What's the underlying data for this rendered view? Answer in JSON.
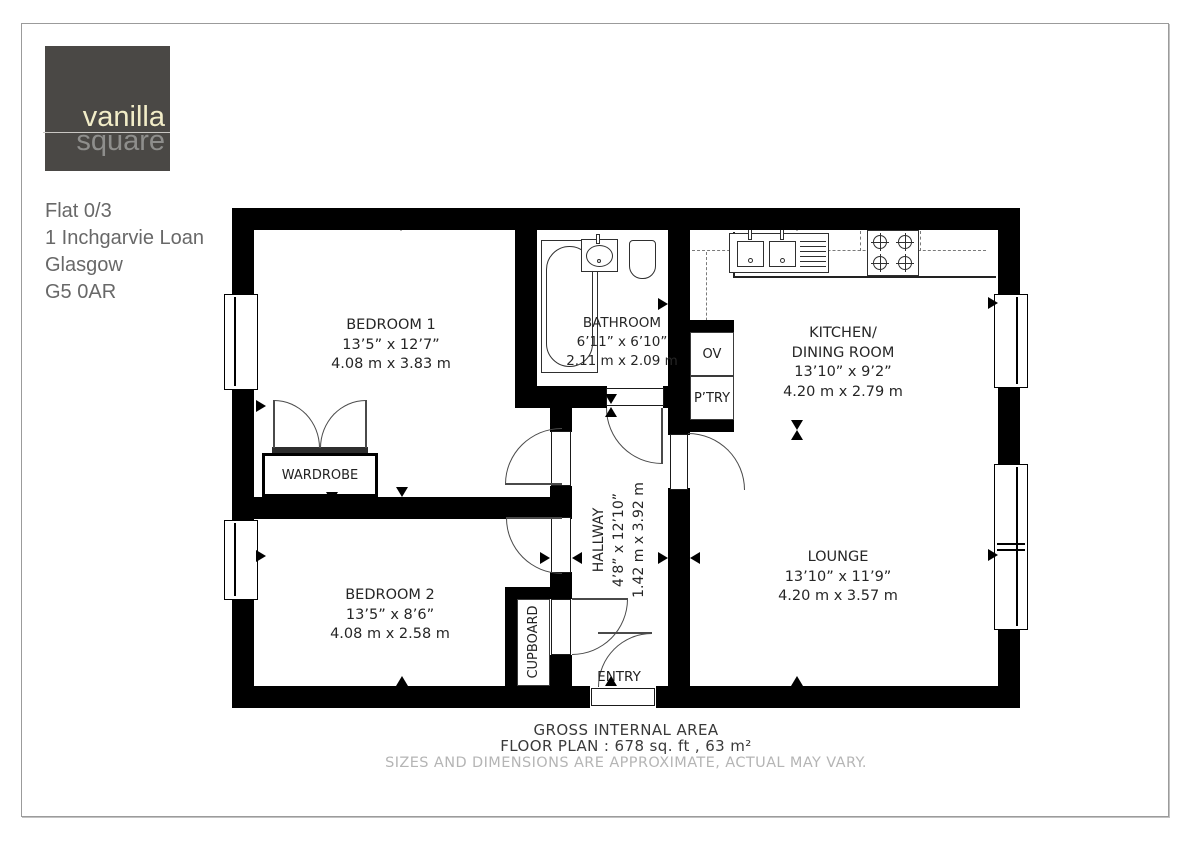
{
  "page": {
    "background": "#ffffff",
    "frame_color": "#9b9b9b"
  },
  "logo": {
    "brand_line1": "vanilla",
    "brand_line2": "square",
    "colors": {
      "box": "#4a4845",
      "line1_text": "#f2edc8",
      "line2_text": "#8e8e8c",
      "divider": "#c9c7c3"
    }
  },
  "address": {
    "line1": "Flat 0/3",
    "line2": "1 Inchgarvie Loan",
    "line3": "Glasgow",
    "line4": "G5 0AR"
  },
  "rooms": {
    "bedroom1": {
      "name": "BEDROOM 1",
      "imperial": "13’5” x 12’7”",
      "metric": "4.08 m x 3.83 m"
    },
    "bathroom": {
      "name": "BATHROOM",
      "imperial": "6’11” x 6’10”",
      "metric": "2.11 m x 2.09 m"
    },
    "kitchen": {
      "name_line1": "KITCHEN/",
      "name_line2": "DINING ROOM",
      "imperial": "13’10” x 9’2”",
      "metric": "4.20 m x 2.79 m"
    },
    "lounge": {
      "name": "LOUNGE",
      "imperial": "13’10” x 11’9”",
      "metric": "4.20 m x 3.57 m"
    },
    "bedroom2": {
      "name": "BEDROOM 2",
      "imperial": "13’5” x 8’6”",
      "metric": "4.08 m x 2.58 m"
    },
    "hallway": {
      "name": "HALLWAY",
      "imperial": "4’8” x 12’10”",
      "metric": "1.42 m x 3.92 m"
    },
    "wardrobe": {
      "name": "WARDROBE"
    },
    "cupboard": {
      "name": "CUPBOARD"
    },
    "entry": {
      "name": "ENTRY"
    },
    "oven": {
      "name": "OV"
    },
    "pantry": {
      "name": "P’TRY"
    }
  },
  "footer": {
    "line1": "GROSS INTERNAL AREA",
    "line2": "FLOOR PLAN : 678 sq. ft , 63 m²",
    "disclaimer": "SIZES AND DIMENSIONS ARE APPROXIMATE, ACTUAL MAY VARY."
  }
}
